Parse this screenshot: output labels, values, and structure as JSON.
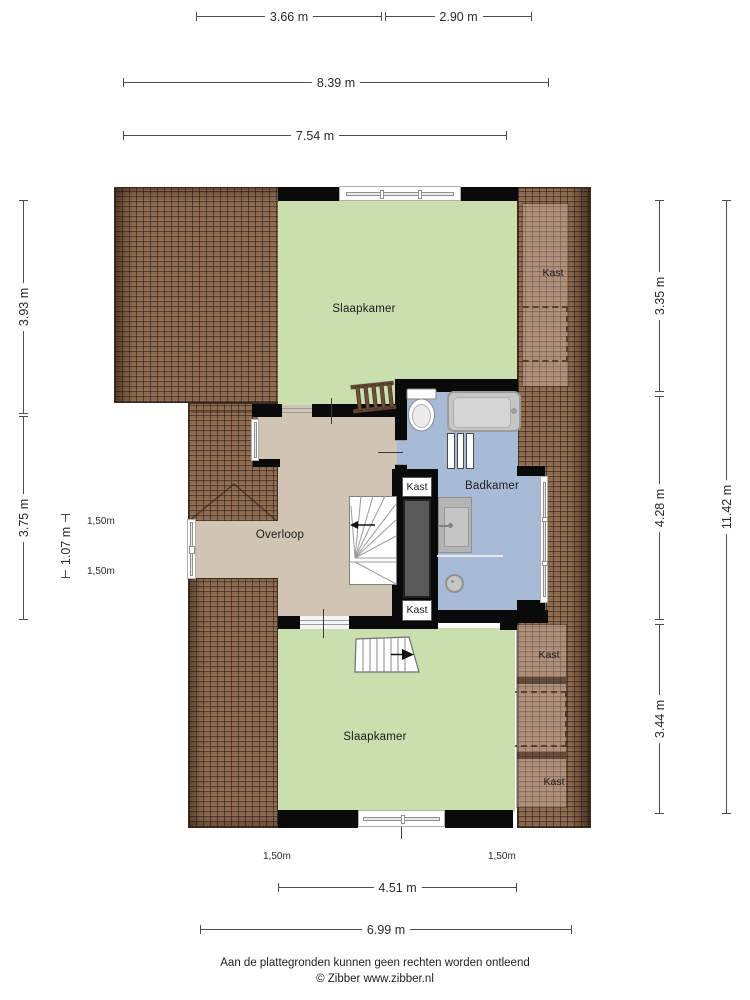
{
  "labels": {
    "bedroom_top": "Slaapkamer",
    "bedroom_bottom": "Slaapkamer",
    "landing": "Overloop",
    "bathroom": "Badkamer",
    "closet_top_right": "Kast",
    "closet_column_top": "Kast",
    "closet_column_bottom": "Kast",
    "closet_right_upper": "Kast",
    "closet_right_lower": "Kast"
  },
  "dimensions": {
    "top": [
      "3.66 m",
      "2.90 m",
      "8.39 m",
      "7.54 m"
    ],
    "left": [
      "3.93 m",
      "3.75 m",
      "1.07 m"
    ],
    "right": [
      "3.35 m",
      "4.28 m",
      "3.44 m",
      "11.42 m"
    ],
    "bottom": [
      "4.51 m",
      "6.99 m"
    ],
    "height_markers": [
      "1,50m",
      "1,50m",
      "1,50m",
      "1,50m"
    ]
  },
  "footer": {
    "disclaimer": "Aan de plattegronden kunnen geen rechten worden ontleend",
    "credit": "© Zibber www.zibber.nl"
  },
  "colors": {
    "room_green": "#cbdeae",
    "room_tan": "#cfc5b2",
    "room_blue": "#a7bbd6",
    "roof_tile": "#8d6a50",
    "wall": "#0a0a0a"
  }
}
